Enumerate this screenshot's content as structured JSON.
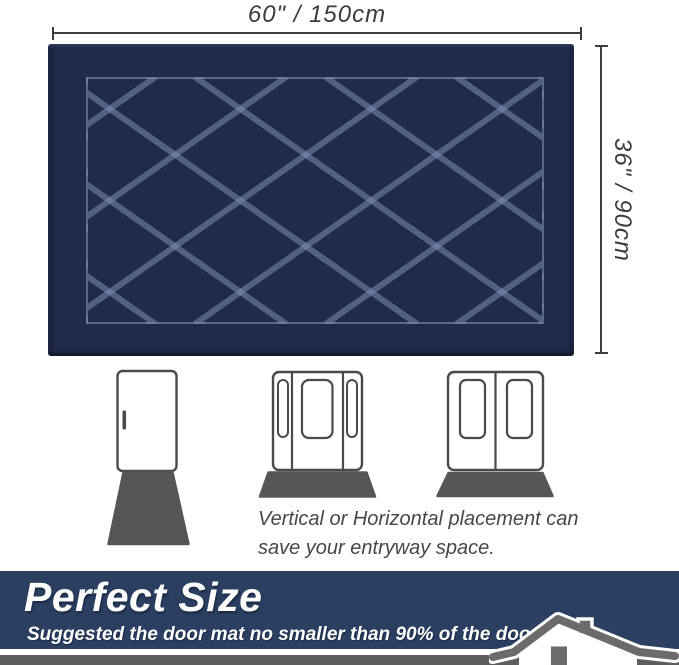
{
  "dimension_labels": {
    "width": "60\" / 150cm",
    "height": "36\" / 90cm"
  },
  "caption": {
    "line1": "Vertical or Horizontal placement can",
    "line2": "save your entryway space."
  },
  "banner": {
    "title": "Perfect Size",
    "subtitle": "Suggested the door mat no smaller than 90% of the door width."
  },
  "colors": {
    "mat_navy": "#202a4b",
    "mat_pattern_line": "#8091b4",
    "banner_navy": "#2b4061",
    "footer_strip_gray": "#5e5e5e",
    "illustration_mat_gray": "#565658",
    "door_outline_gray": "#4a4a4a",
    "house_gray": "#6b6b6b",
    "dimension_gray": "#3f3f3f"
  },
  "icons": {
    "single_door": "single-door-with-vertical-mat",
    "sidelight_door": "door-with-sidelights-and-horizontal-mat",
    "double_door": "double-door-with-horizontal-mat",
    "house": "house-icon"
  }
}
